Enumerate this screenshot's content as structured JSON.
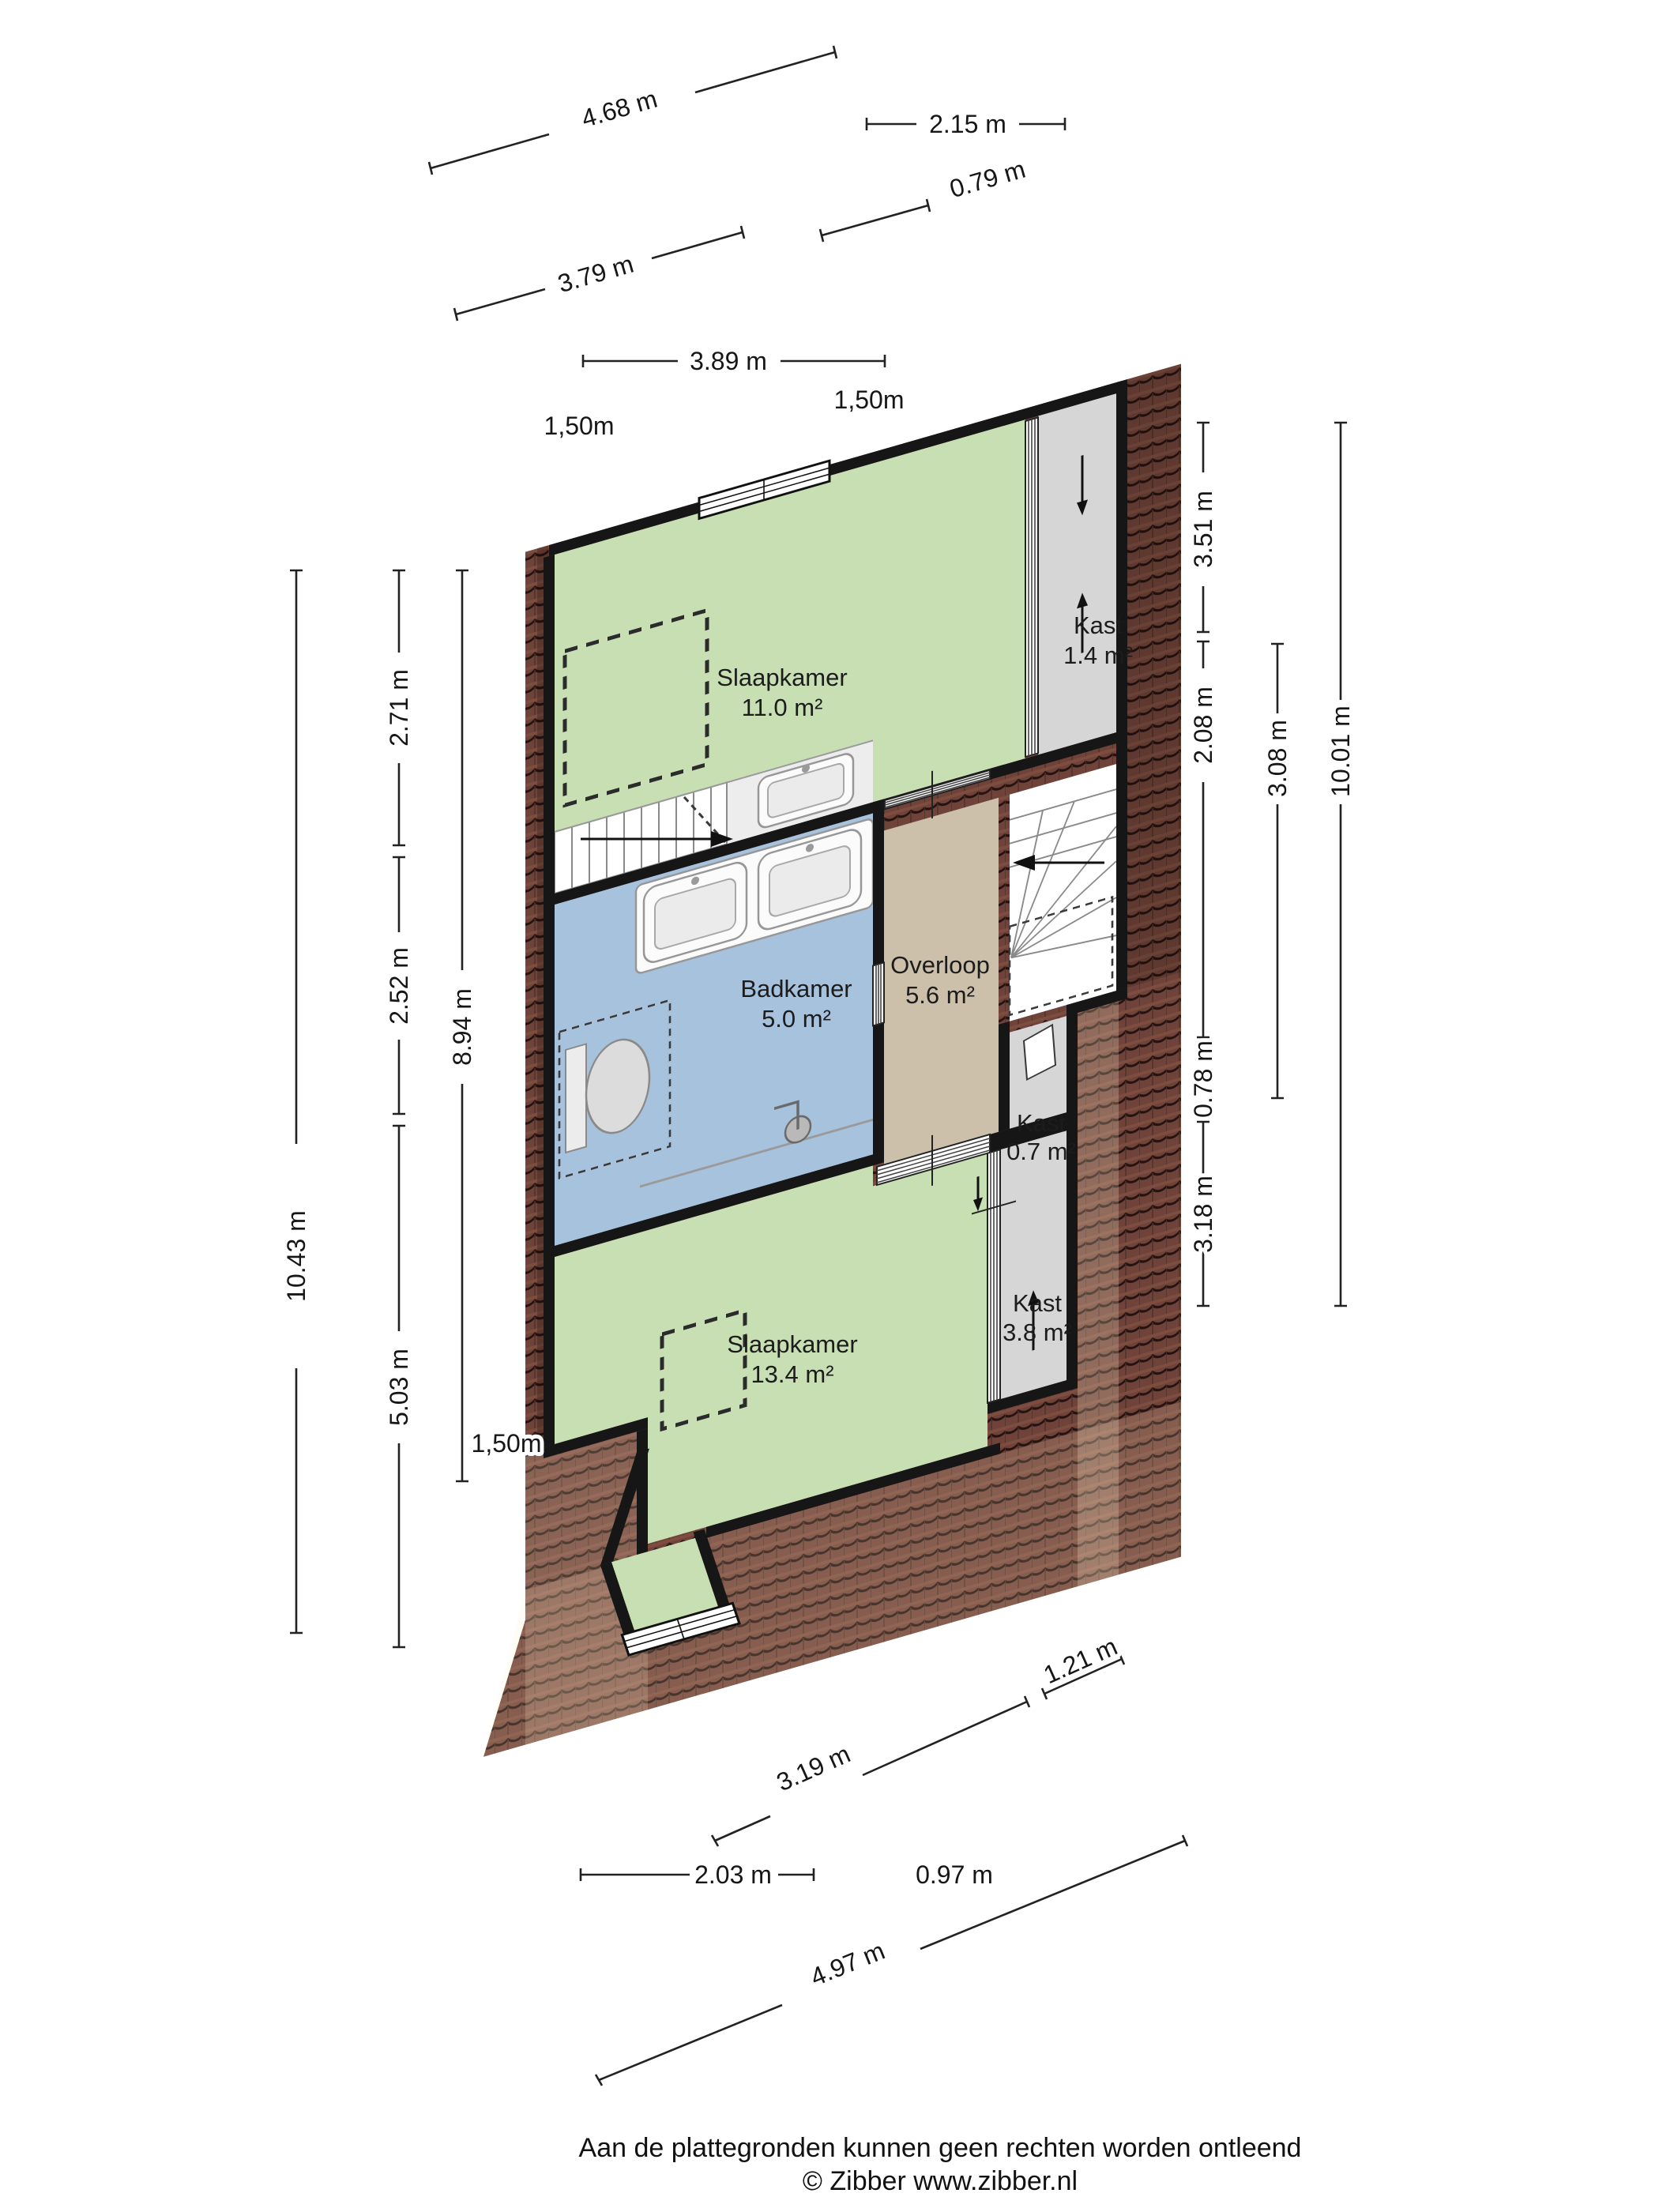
{
  "plan": {
    "type": "floorplan",
    "rooms": [
      {
        "id": "slaapkamer-1",
        "name": "Slaapkamer",
        "area": "11.0 m²"
      },
      {
        "id": "kast-1",
        "name": "Kast",
        "area": "1.4 m²"
      },
      {
        "id": "badkamer",
        "name": "Badkamer",
        "area": "5.0 m²"
      },
      {
        "id": "overloop",
        "name": "Overloop",
        "area": "5.6 m²"
      },
      {
        "id": "kast-2",
        "name": "Kast",
        "area": "0.7 m²"
      },
      {
        "id": "slaapkamer-2",
        "name": "Slaapkamer",
        "area": "13.4 m²"
      },
      {
        "id": "kast-3",
        "name": "Kast",
        "area": "3.8 m²"
      }
    ],
    "height_markers": [
      {
        "label": "1,50m"
      },
      {
        "label": "1,50m"
      },
      {
        "label": "1,50m"
      }
    ],
    "dimensions": {
      "top": [
        {
          "label": "4.68 m"
        },
        {
          "label": "2.15 m"
        },
        {
          "label": "0.79 m"
        },
        {
          "label": "3.79 m"
        },
        {
          "label": "3.89 m"
        }
      ],
      "left": [
        {
          "label": "10.43 m"
        },
        {
          "label": "2.71 m"
        },
        {
          "label": "2.52 m"
        },
        {
          "label": "5.03 m"
        },
        {
          "label": "8.94 m"
        }
      ],
      "right": [
        {
          "label": "3.51 m"
        },
        {
          "label": "2.08 m"
        },
        {
          "label": "0.78 m"
        },
        {
          "label": "3.18 m"
        },
        {
          "label": "3.08 m"
        },
        {
          "label": "10.01 m"
        }
      ],
      "bottom": [
        {
          "label": "3.19 m"
        },
        {
          "label": "1.21 m"
        },
        {
          "label": "2.03 m"
        },
        {
          "label": "0.97 m"
        },
        {
          "label": "4.97 m"
        }
      ]
    },
    "colors": {
      "bedroom": "#c8dfb4",
      "bathroom": "#a7c2dd",
      "landing": "#ccc0ab",
      "closet": "#d6d6d6",
      "roof": "#6f4339",
      "wall": "#161616"
    }
  },
  "footer": {
    "disclaimer": "Aan de plattegronden kunnen geen rechten worden ontleend",
    "copyright": "© Zibber www.zibber.nl"
  }
}
